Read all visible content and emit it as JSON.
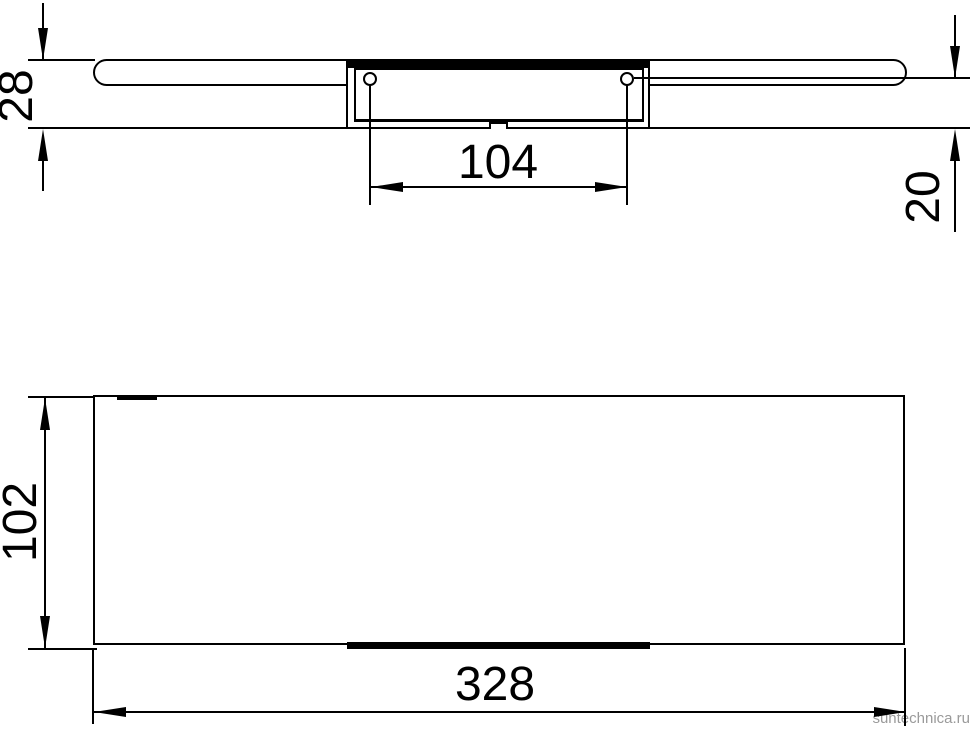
{
  "drawing": {
    "type": "technical-dimension-drawing",
    "views": {
      "top_view": {
        "description": "plan view of rail with wall mounting plate, two screw holes, center notch",
        "dimensions": {
          "overall_depth": "28",
          "screw_hole_spacing": "104",
          "hole_to_edge_depth": "20"
        }
      },
      "front_view": {
        "description": "front face of shelf panel with mounting strip visible below",
        "dimensions": {
          "height": "102",
          "width": "328"
        }
      }
    },
    "colors": {
      "line": "#000000",
      "background": "#ffffff",
      "watermark": "#9a9a9a"
    },
    "watermark": "suntechnica.ru"
  }
}
